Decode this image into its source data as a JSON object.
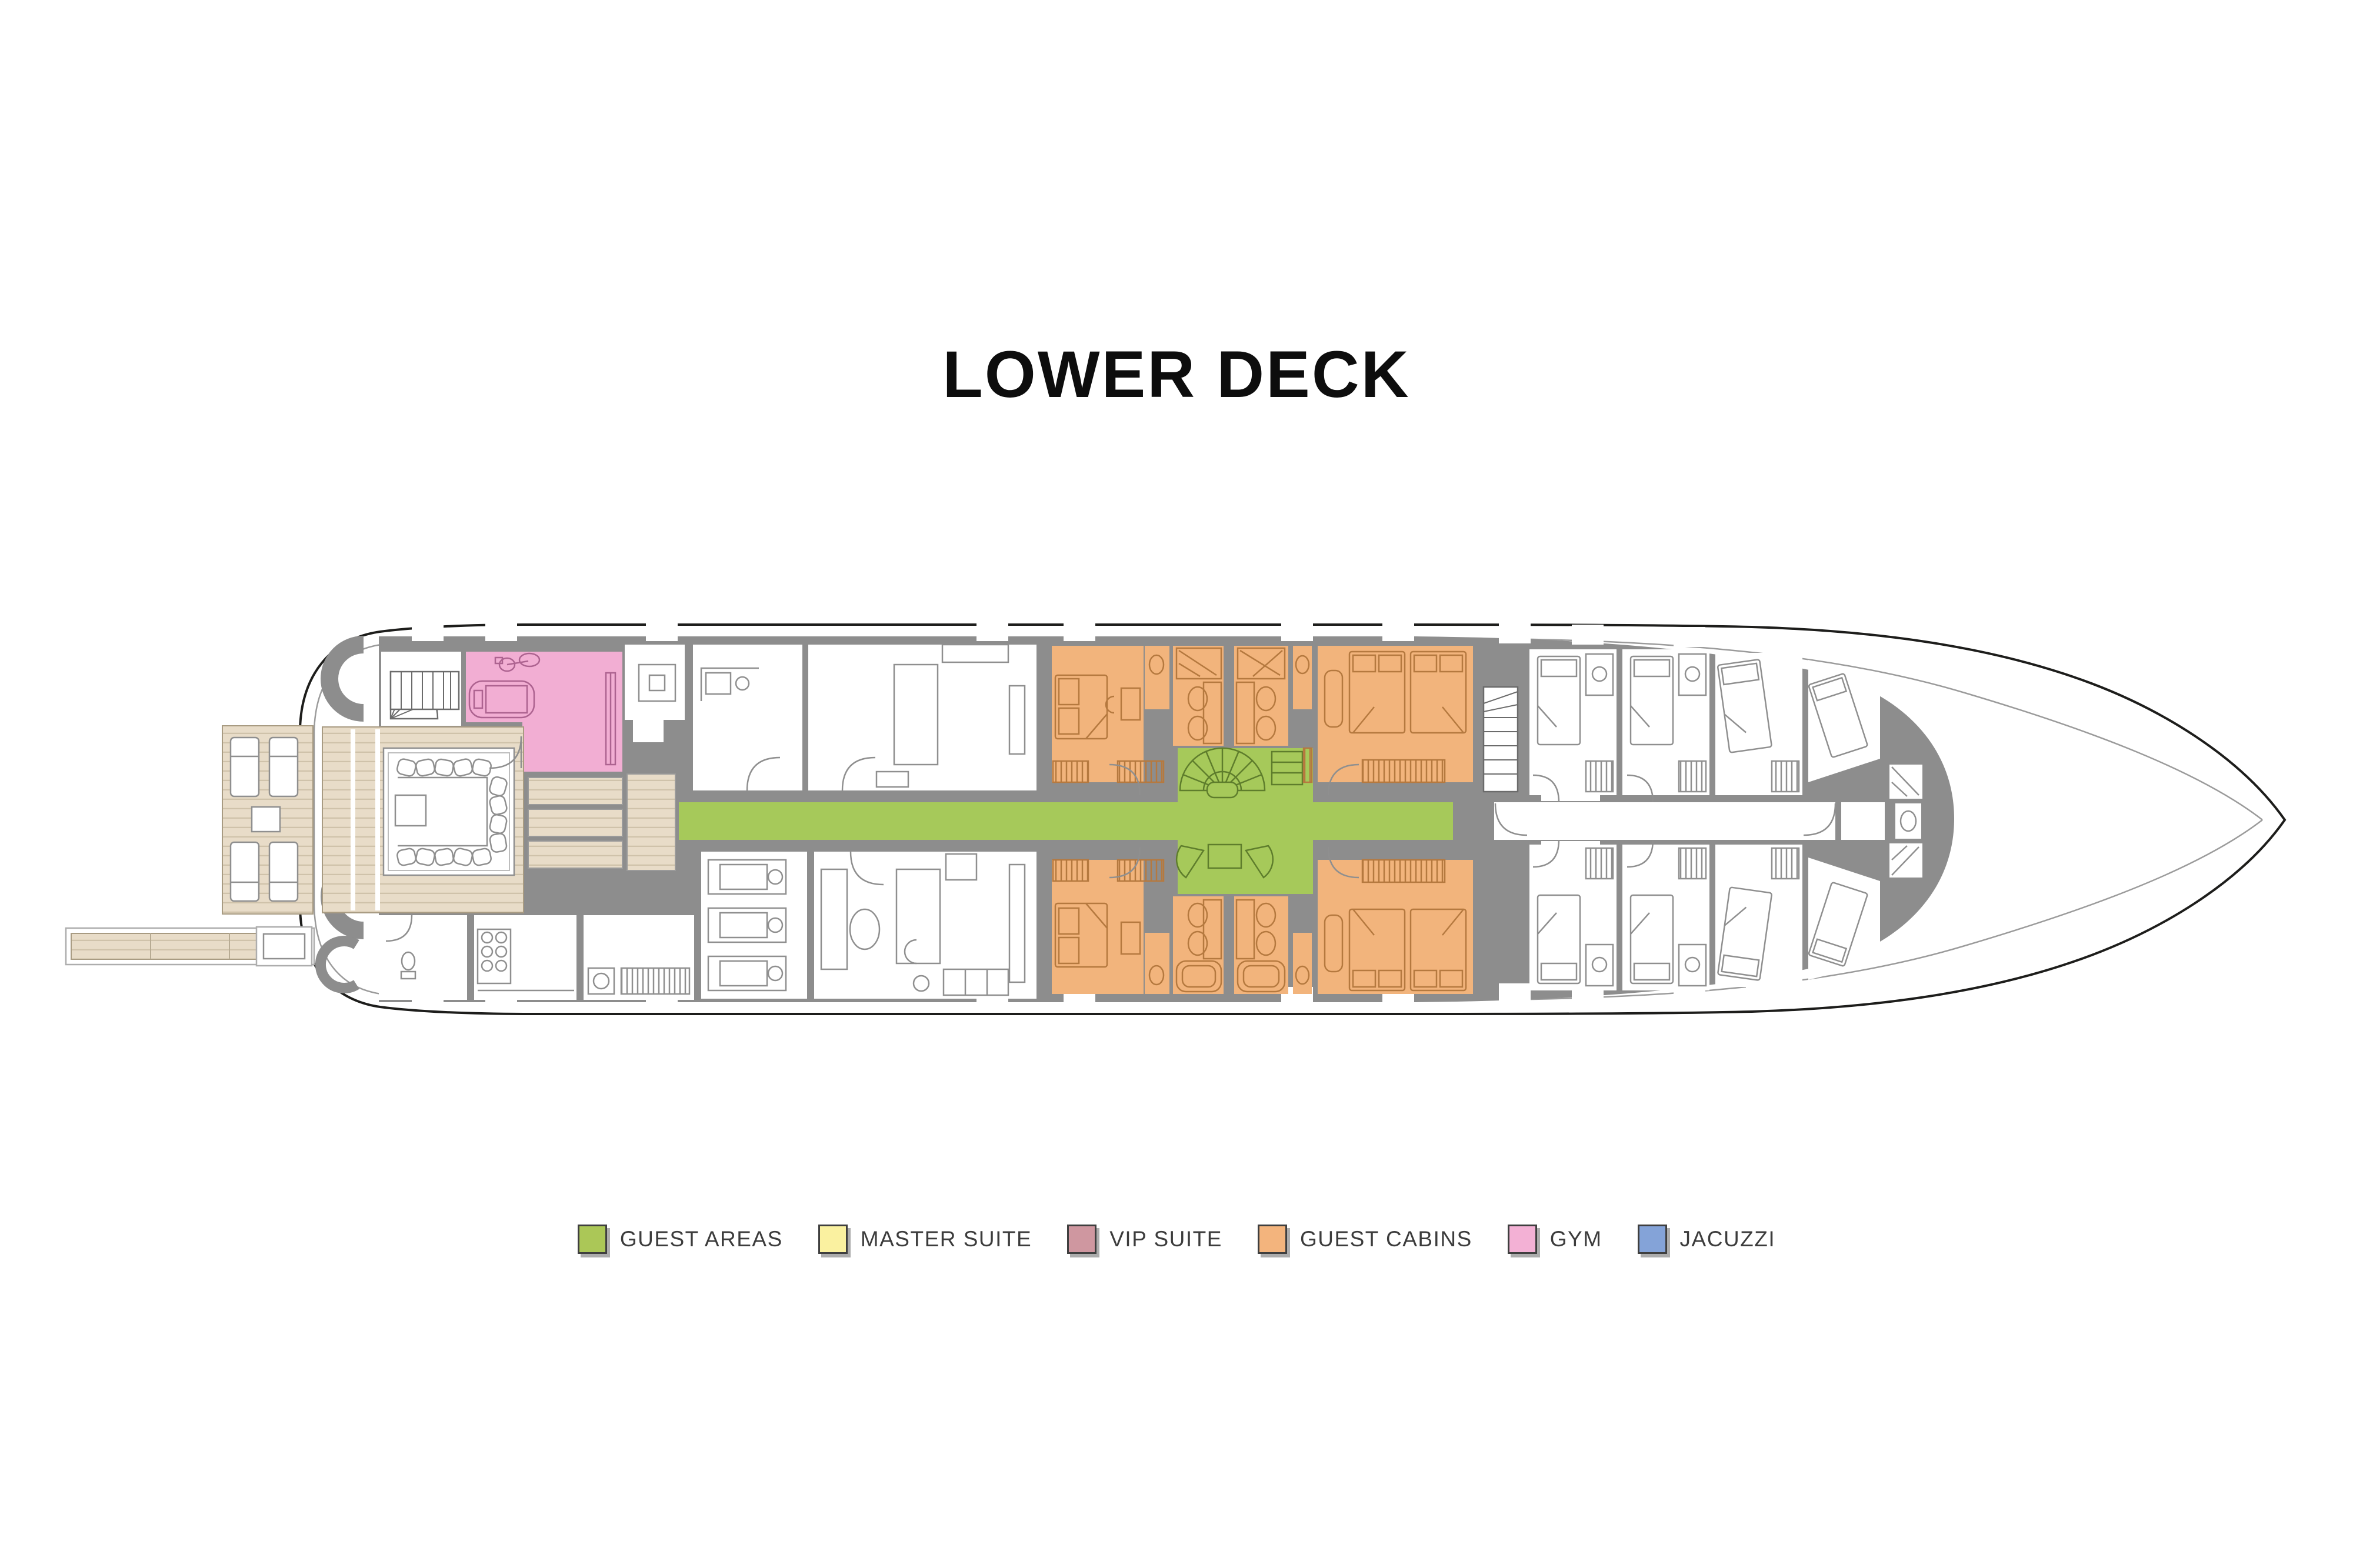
{
  "title": "LOWER DECK",
  "legend": {
    "items": [
      {
        "id": "guest-areas",
        "label": "GUEST AREAS",
        "color": "#abc757"
      },
      {
        "id": "master-suite",
        "label": "MASTER SUITE",
        "color": "#faf1a0"
      },
      {
        "id": "vip-suite",
        "label": "VIP SUITE",
        "color": "#cf97a0"
      },
      {
        "id": "guest-cabins",
        "label": "GUEST CABINS",
        "color": "#f3b47d"
      },
      {
        "id": "gym",
        "label": "GYM",
        "color": "#f3b1d5"
      },
      {
        "id": "jacuzzi",
        "label": "JACUZZI",
        "color": "#84a3d8"
      }
    ]
  },
  "plan": {
    "zone_colors": {
      "guest_areas": "#a6c95a",
      "gym": "#f2aed3",
      "guest_cabins": "#f2b47c"
    },
    "palette": {
      "walls": "#8d8d8d",
      "hull_line": "#1d1d1b",
      "inner_line": "#9b9b9b",
      "deck": "#e8dcc8",
      "plank": "#cfc2aa",
      "outline": "#8f8f8f",
      "furn_orange": "#b5793f",
      "furn_pink": "#ad6390",
      "furn_green": "#5e7d2c"
    },
    "colored_zones": [
      {
        "name": "main-corridor-and-lobby",
        "category": "GUEST AREAS"
      },
      {
        "name": "gym-room",
        "category": "GYM"
      },
      {
        "name": "guest-cabins-block",
        "category": "GUEST CABINS"
      }
    ]
  }
}
